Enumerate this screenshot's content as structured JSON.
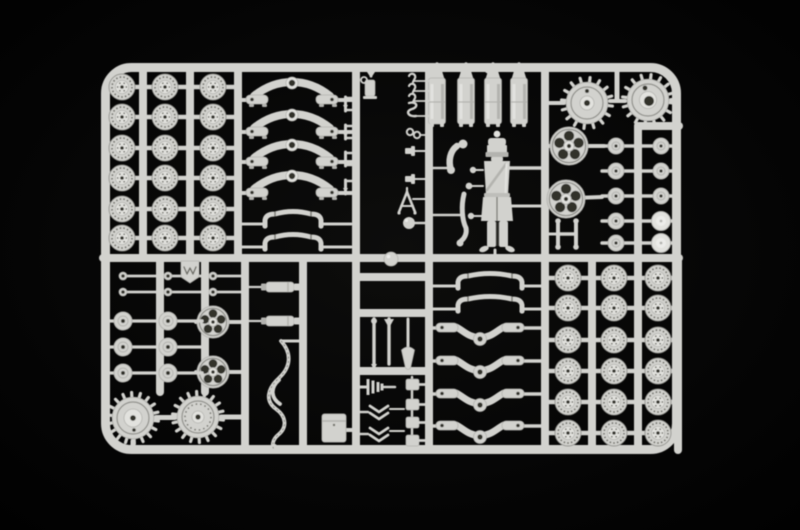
{
  "scene": {
    "subject": "injection-molded light gray plastic model kit sprue with artillery wheels, suspension springs, bogies, buckets, crew figure and tools photographed on a black background",
    "background": "#000000",
    "vignette": "#0d0d0c",
    "palette": {
      "plastic": "#d2d2ce",
      "plastic_light": "#e2e2de",
      "plastic_mid": "#b3b3af",
      "plastic_dark": "#8f8f8a",
      "detail": "#6e6e67",
      "hole": "#31312c",
      "highlight": "#ecece9"
    }
  },
  "sprue": {
    "frame": {
      "x": 101,
      "y": 63,
      "w": 580,
      "h": 391,
      "corner_r": 30,
      "thickness": 9
    },
    "v_rails": [
      [
        143,
        67,
        258
      ],
      [
        190,
        67,
        258
      ],
      [
        238,
        67,
        258
      ],
      [
        356,
        67,
        450
      ],
      [
        429,
        67,
        450
      ],
      [
        545,
        67,
        450
      ],
      [
        638,
        126,
        258
      ],
      [
        160,
        258,
        392
      ],
      [
        205,
        258,
        392
      ],
      [
        245,
        258,
        450
      ],
      [
        303,
        258,
        450
      ],
      [
        592,
        258,
        450
      ],
      [
        638,
        258,
        450
      ],
      [
        678,
        258,
        450
      ]
    ],
    "h_rails": [
      [
        258,
        103,
        679
      ],
      [
        126,
        638,
        679
      ],
      [
        277,
        356,
        429
      ],
      [
        313,
        356,
        429
      ],
      [
        371,
        356,
        429
      ]
    ],
    "road_wheel_grids": [
      {
        "rows": [
          87,
          117,
          148,
          178,
          209,
          238
        ],
        "xs": [
          122,
          165,
          213
        ],
        "x1": 104,
        "x2": 238
      },
      {
        "rows": [
          278,
          308,
          340,
          371,
          402,
          433
        ],
        "xs": [
          568,
          614,
          658
        ],
        "x1": 547,
        "x2": 678
      }
    ],
    "sprockets": [
      {
        "cx": 587,
        "cy": 103,
        "r": 23,
        "teeth": 16,
        "hub": "ring"
      },
      {
        "cx": 648,
        "cy": 100,
        "r": 23,
        "teeth": 16,
        "hub": "big_hole"
      },
      {
        "cx": 133,
        "cy": 418,
        "r": 23,
        "teeth": 18,
        "hub": "plain"
      },
      {
        "cx": 198,
        "cy": 417,
        "r": 23,
        "teeth": 18,
        "hub": "rivets"
      }
    ],
    "sprocket_stubs": [
      [
        549,
        103,
        564,
        103,
        4
      ],
      [
        610,
        101,
        625,
        101,
        4
      ],
      [
        617,
        67,
        617,
        99,
        5
      ],
      [
        671,
        100,
        678,
        100,
        4
      ],
      [
        133,
        441,
        133,
        450,
        5
      ],
      [
        156,
        417.5,
        175,
        417.5,
        5
      ],
      [
        221,
        417,
        245,
        417,
        5
      ]
    ],
    "spoked_wheels": [
      [
        569,
        146,
        19
      ],
      [
        566,
        199,
        19
      ],
      [
        213,
        322,
        16
      ],
      [
        213,
        372,
        16
      ]
    ],
    "spoked_stubs": [
      [
        547,
        146,
        604,
        146
      ],
      [
        547,
        199,
        602,
        197
      ],
      [
        196,
        322,
        243,
        322
      ],
      [
        196,
        372,
        243,
        372
      ]
    ],
    "leaf_springs": {
      "cys": [
        90,
        122,
        152,
        183
      ]
    },
    "arch_bars": [
      {
        "x1": 265,
        "x2": 321,
        "cy": 218,
        "railL": 241,
        "railR": 351
      },
      {
        "x1": 265,
        "x2": 321,
        "cy": 241,
        "railL": 241,
        "railR": 351
      },
      {
        "x1": 458,
        "x2": 522,
        "cy": 280,
        "railL": 432,
        "railR": 543
      },
      {
        "x1": 458,
        "x2": 522,
        "cy": 303,
        "railL": 432,
        "railR": 543
      }
    ],
    "v_bogies": {
      "cys": [
        330,
        363,
        396,
        428
      ]
    },
    "cylinders": {
      "items": [
        {
          "cx": 437,
          "ring": true
        },
        {
          "cx": 466,
          "ring": false
        },
        {
          "cx": 493,
          "ring": true
        },
        {
          "cx": 519,
          "ring": false
        }
      ]
    },
    "disc_pair_rows": {
      "x_left": 616,
      "x_right": 661,
      "ys": [
        146,
        171,
        196,
        221,
        243
      ],
      "dome_from": 3
    },
    "pins": {
      "ys": [
        276,
        292
      ],
      "xs": [
        123,
        168,
        213
      ],
      "rail_ends": [
        157,
        202,
        242
      ]
    },
    "flat_discs": {
      "ys": [
        321,
        347,
        373
      ],
      "xs": [
        123,
        168
      ],
      "stubs": [
        [
          104,
          157
        ],
        [
          160,
          202
        ]
      ]
    },
    "cyl_rods": {
      "ys": [
        287,
        321
      ]
    },
    "cable": {
      "x": 278,
      "y_top": 341
    },
    "toolbox": {
      "x": 322,
      "y": 414,
      "w": 24,
      "h": 28
    },
    "tools_mid": {
      "rod1_x": 374,
      "rod2_x": 389,
      "shovel_x": 408
    },
    "muzzle_stack": {
      "cy": 387
    },
    "chevrons": {
      "cys": [
        411,
        433
      ]
    },
    "blocks": {
      "ys": [
        379,
        399,
        417,
        435
      ]
    },
    "small_tools": {
      "hook_ys": [
        78,
        88,
        98
      ],
      "ring_y": 133,
      "s_hook_y": 108,
      "bracket_ys": [
        151,
        179
      ],
      "aframe_cy": 201,
      "ball_y": 223
    },
    "t_pin_ys": [
      104,
      132,
      159,
      187
    ],
    "jack_tool": {
      "x": 366,
      "y": 74
    },
    "h_bracket": {
      "x": 558,
      "y": 223
    },
    "tag": {
      "x": 181,
      "y": 261
    },
    "rail_ball": {
      "cx": 391,
      "cy": 259,
      "r": 7
    },
    "soldier": {
      "cx": 497
    }
  }
}
